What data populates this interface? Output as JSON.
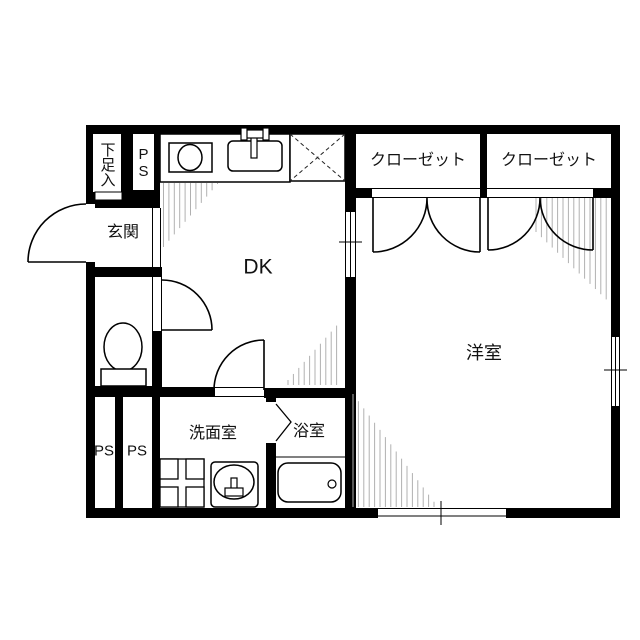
{
  "floorplan": {
    "rooms": {
      "shoe_cabinet": {
        "label": "下足入"
      },
      "ps_top": {
        "label": "PS"
      },
      "entrance": {
        "label": "玄関"
      },
      "dining_kitchen": {
        "label": "DK"
      },
      "closet_left": {
        "label": "クローゼット"
      },
      "closet_right": {
        "label": "クローゼット"
      },
      "western_room": {
        "label": "洋室"
      },
      "washroom": {
        "label": "洗面室"
      },
      "bathroom": {
        "label": "浴室"
      },
      "ps_bottom_left": {
        "label": "PS"
      },
      "ps_bottom_right": {
        "label": "PS"
      }
    },
    "icons": [
      "stove-icon",
      "sink-icon",
      "faucet-icon",
      "refrigerator-space-icon",
      "toilet-icon",
      "washing-machine-pan-icon",
      "washbasin-icon",
      "bathtub-icon",
      "entrance-door-icon",
      "toilet-door-icon",
      "washroom-door-icon",
      "closet-double-door-icon",
      "bath-folding-door-icon",
      "sliding-window-icon"
    ],
    "colors": {
      "wall": "#000000",
      "floor": "#ffffff",
      "hatch": "#b0b0b0",
      "line": "#111111"
    }
  }
}
